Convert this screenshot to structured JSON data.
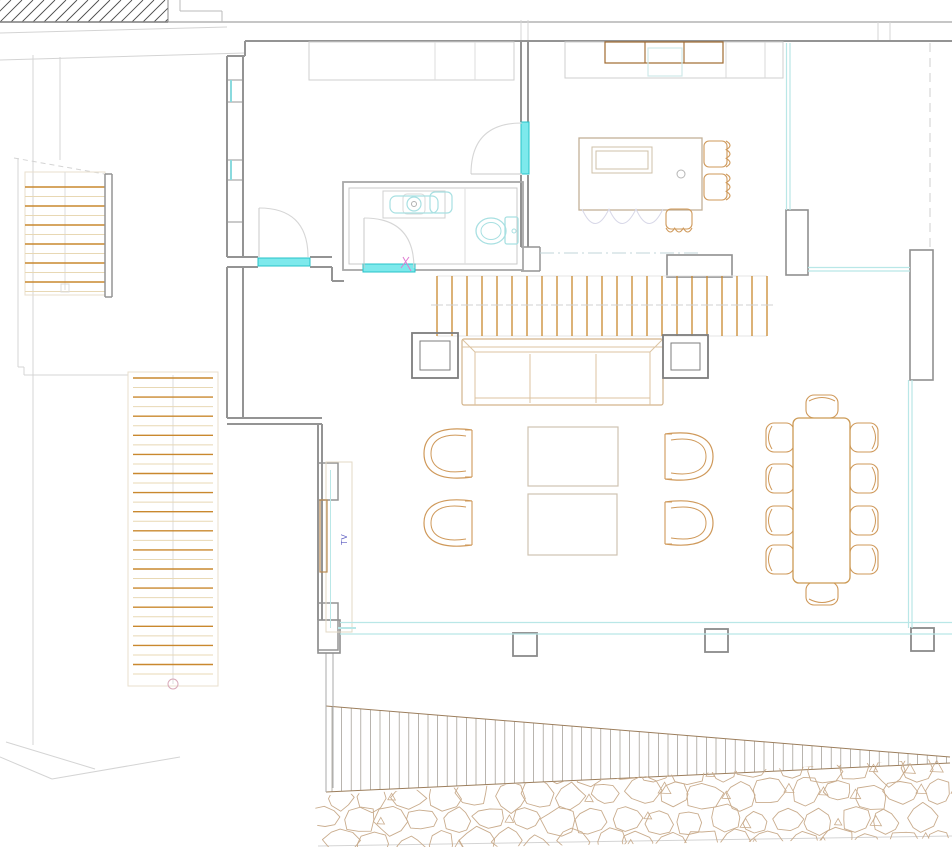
{
  "title": "Residential floor plan - living level (CAD drawing)",
  "labels": {
    "tv": "TV"
  },
  "colors": {
    "wall": "#949494",
    "wall_light": "#bfbfbf",
    "faint": "#dedede",
    "site": "#d4d4d4",
    "tan": "#cf995a",
    "tan_light": "#e3d2b8",
    "orange": "#c9882e",
    "tread_light": "#e8d8b4",
    "brown": "#a06a30",
    "gray_furniture": "#7e7e7e",
    "cyan_fill": "#7de9ec",
    "cyan_edge": "#27c3c9",
    "cyan": "#b9e7e7",
    "cyan_fixture": "#a8e0e2",
    "stone": "#c9ac8d",
    "wedge_edge": "#9c7e5c",
    "hatch_gray": "#9a958c",
    "hatch_dark": "#4a4a4a",
    "tv_text": "#5b5bc0",
    "pink": "#e07ad2",
    "scallop": "#d8d8e8",
    "dashdot": "#c2d4da",
    "arc": "#d6d6d6",
    "stair_box": "#e8dfce",
    "marker_pink": "#d8aab8"
  },
  "drawing": {
    "canvas": {
      "w": 952,
      "h": 847
    },
    "site_lines": [
      {
        "x1": 0,
        "y1": 22,
        "x2": 952,
        "y2": 22,
        "c": "#b3b3b3",
        "w": 1.4
      },
      {
        "x1": 0,
        "y1": 33,
        "x2": 227,
        "y2": 27
      },
      {
        "x1": 0,
        "y1": 60,
        "x2": 245,
        "y2": 53
      },
      {
        "x1": 33,
        "y1": 55,
        "x2": 33,
        "y2": 745
      },
      {
        "x1": 60,
        "y1": 57,
        "x2": 60,
        "y2": 160
      },
      {
        "x1": 18,
        "y1": 158,
        "x2": 18,
        "y2": 367
      },
      {
        "x1": 18,
        "y1": 367,
        "x2": 24,
        "y2": 367
      },
      {
        "x1": 24,
        "y1": 367,
        "x2": 24,
        "y2": 375
      },
      {
        "x1": 24,
        "y1": 375,
        "x2": 128,
        "y2": 375
      },
      {
        "x1": 14,
        "y1": 158,
        "x2": 110,
        "y2": 175,
        "dash": "5,4"
      },
      {
        "x1": 6,
        "y1": 742,
        "x2": 95,
        "y2": 769
      },
      {
        "x1": 0,
        "y1": 757,
        "x2": 52,
        "y2": 779
      },
      {
        "x1": 52,
        "y1": 779,
        "x2": 180,
        "y2": 757
      },
      {
        "x1": 318,
        "y1": 846,
        "x2": 952,
        "y2": 836
      },
      {
        "x1": 521,
        "y1": 20,
        "x2": 521,
        "y2": 41
      },
      {
        "x1": 528,
        "y1": 20,
        "x2": 528,
        "y2": 41
      },
      {
        "x1": 878,
        "y1": 22,
        "x2": 878,
        "y2": 41
      },
      {
        "x1": 890,
        "y1": 22,
        "x2": 890,
        "y2": 41
      },
      {
        "x1": 180,
        "y1": 0,
        "x2": 180,
        "y2": 11,
        "c": "#bbbbbb"
      },
      {
        "x1": 180,
        "y1": 11,
        "x2": 222,
        "y2": 11,
        "c": "#bbbbbb"
      },
      {
        "x1": 222,
        "y1": 11,
        "x2": 222,
        "y2": 22,
        "c": "#bbbbbb"
      }
    ],
    "walls": [
      {
        "x1": 245,
        "y1": 41,
        "x2": 952,
        "y2": 41,
        "w": 2
      },
      {
        "x1": 245,
        "y1": 41,
        "x2": 245,
        "y2": 56,
        "w": 2
      },
      {
        "x1": 227,
        "y1": 56,
        "x2": 245,
        "y2": 56,
        "w": 2
      },
      {
        "x1": 227,
        "y1": 56,
        "x2": 227,
        "y2": 257,
        "w": 2
      },
      {
        "x1": 243,
        "y1": 56,
        "x2": 243,
        "y2": 257,
        "w": 2
      },
      {
        "x1": 227,
        "y1": 80,
        "x2": 243,
        "y2": 80,
        "w": 1
      },
      {
        "x1": 227,
        "y1": 102,
        "x2": 243,
        "y2": 102,
        "w": 1
      },
      {
        "x1": 227,
        "y1": 160,
        "x2": 243,
        "y2": 160,
        "w": 1
      },
      {
        "x1": 227,
        "y1": 180,
        "x2": 243,
        "y2": 180,
        "w": 1
      },
      {
        "x1": 227,
        "y1": 222,
        "x2": 243,
        "y2": 222,
        "w": 1
      },
      {
        "x1": 227,
        "y1": 257,
        "x2": 258,
        "y2": 257,
        "w": 2
      },
      {
        "x1": 227,
        "y1": 267,
        "x2": 258,
        "y2": 267,
        "w": 2
      },
      {
        "x1": 310,
        "y1": 257,
        "x2": 332,
        "y2": 257,
        "w": 2
      },
      {
        "x1": 310,
        "y1": 267,
        "x2": 332,
        "y2": 267,
        "w": 2
      },
      {
        "x1": 332,
        "y1": 267,
        "x2": 332,
        "y2": 281,
        "w": 2
      },
      {
        "x1": 332,
        "y1": 281,
        "x2": 344,
        "y2": 281,
        "w": 2
      },
      {
        "x1": 521,
        "y1": 41,
        "x2": 521,
        "y2": 122,
        "w": 2
      },
      {
        "x1": 528,
        "y1": 41,
        "x2": 528,
        "y2": 122,
        "w": 2
      },
      {
        "x1": 521,
        "y1": 175,
        "x2": 521,
        "y2": 247,
        "w": 2
      },
      {
        "x1": 528,
        "y1": 175,
        "x2": 528,
        "y2": 247,
        "w": 2
      },
      {
        "x1": 521,
        "y1": 247,
        "x2": 540,
        "y2": 247,
        "w": 1.5
      },
      {
        "x1": 540,
        "y1": 247,
        "x2": 540,
        "y2": 271,
        "w": 1.5
      },
      {
        "x1": 521,
        "y1": 271,
        "x2": 540,
        "y2": 271,
        "w": 1.5
      },
      {
        "x1": 227,
        "y1": 267,
        "x2": 227,
        "y2": 418,
        "w": 2
      },
      {
        "x1": 243,
        "y1": 267,
        "x2": 243,
        "y2": 418,
        "w": 2
      },
      {
        "x1": 227,
        "y1": 418,
        "x2": 322,
        "y2": 418,
        "w": 2
      },
      {
        "x1": 227,
        "y1": 424,
        "x2": 322,
        "y2": 424,
        "w": 2
      },
      {
        "x1": 318,
        "y1": 424,
        "x2": 318,
        "y2": 620,
        "w": 2
      },
      {
        "x1": 322,
        "y1": 424,
        "x2": 322,
        "y2": 620,
        "w": 2
      },
      {
        "x1": 105,
        "y1": 174,
        "x2": 105,
        "y2": 297,
        "w": 1.5
      },
      {
        "x1": 112,
        "y1": 174,
        "x2": 112,
        "y2": 297,
        "w": 1.5
      },
      {
        "x1": 105,
        "y1": 174,
        "x2": 112,
        "y2": 174,
        "w": 1.5
      },
      {
        "x1": 105,
        "y1": 297,
        "x2": 112,
        "y2": 297,
        "w": 1.5
      },
      {
        "x1": 326,
        "y1": 653,
        "x2": 326,
        "y2": 792,
        "w": 1,
        "c": "#aaaaaa"
      },
      {
        "x1": 333,
        "y1": 653,
        "x2": 333,
        "y2": 788,
        "w": 1,
        "c": "#aaaaaa"
      }
    ],
    "rects": [
      {
        "x": 343,
        "y": 182,
        "w": 180,
        "h": 88,
        "c": "#a8a8a8",
        "sw": 1.8,
        "n": "bathroom-outline"
      },
      {
        "x": 349,
        "y": 188,
        "w": 168,
        "h": 76,
        "c": "#c9c9c9",
        "sw": 1,
        "n": "bathroom-inner"
      },
      {
        "x": 309,
        "y": 42,
        "w": 205,
        "h": 38,
        "c": "#cfcfcf",
        "sw": 1,
        "n": "wardrobe"
      },
      {
        "x": 667,
        "y": 255,
        "w": 65,
        "h": 22,
        "c": "#8f8f8f",
        "sw": 1.6,
        "n": "sideboard"
      },
      {
        "x": 786,
        "y": 210,
        "w": 22,
        "h": 65,
        "c": "#8f8f8f",
        "sw": 1.6,
        "n": "wall-pier"
      },
      {
        "x": 910,
        "y": 250,
        "w": 23,
        "h": 130,
        "c": "#8f8f8f",
        "sw": 1.6,
        "n": "wall-pier"
      },
      {
        "x": 318,
        "y": 620,
        "w": 22,
        "h": 33,
        "c": "#8f8f8f",
        "sw": 1.6,
        "n": "deck-wall-block"
      },
      {
        "x": 513,
        "y": 633,
        "w": 24,
        "h": 23,
        "c": "#8a8a8a",
        "sw": 1.8,
        "n": "deck-post"
      },
      {
        "x": 705,
        "y": 629,
        "w": 23,
        "h": 23,
        "c": "#8a8a8a",
        "sw": 1.8,
        "n": "deck-post"
      },
      {
        "x": 911,
        "y": 628,
        "w": 23,
        "h": 23,
        "c": "#8a8a8a",
        "sw": 1.8,
        "n": "deck-post"
      },
      {
        "x": 318,
        "y": 463,
        "w": 20,
        "h": 37,
        "c": "#949494",
        "sw": 1.5,
        "n": "tv-wall-pier"
      },
      {
        "x": 318,
        "y": 603,
        "w": 20,
        "h": 47,
        "c": "#949494",
        "sw": 1.5,
        "n": "tv-wall-pier"
      },
      {
        "x": 326,
        "y": 462,
        "w": 26,
        "h": 170,
        "c": "#e3d9c6",
        "sw": 1,
        "n": "tv-niche"
      },
      {
        "x": 320,
        "y": 500,
        "w": 7,
        "h": 72,
        "c": "#b98a50",
        "sw": 1.2,
        "n": "tv-board"
      },
      {
        "x": 61,
        "y": 284,
        "w": 8,
        "h": 8,
        "c": "#dcdcdc",
        "sw": 1,
        "n": "stair-marker"
      }
    ],
    "faint_lines": [
      {
        "x1": 435,
        "y1": 42,
        "x2": 435,
        "y2": 80
      },
      {
        "x1": 475,
        "y1": 42,
        "x2": 475,
        "y2": 80
      },
      {
        "x1": 465,
        "y1": 188,
        "x2": 465,
        "y2": 264
      },
      {
        "x1": 540,
        "y1": 253,
        "x2": 700,
        "y2": 253,
        "dash": "14,4,2,4",
        "c": "#c2d4da"
      },
      {
        "x1": 930,
        "y1": 43,
        "x2": 930,
        "y2": 250,
        "dash": "9,6",
        "c": "#cfcfcf"
      }
    ],
    "cyan_bands": [
      {
        "x": 258,
        "y": 258,
        "w": 52,
        "h": 8,
        "n": "window-sill"
      },
      {
        "x": 363,
        "y": 264,
        "w": 52,
        "h": 8,
        "n": "door-threshold"
      },
      {
        "x": 521,
        "y": 122,
        "w": 8,
        "h": 52,
        "n": "door-threshold"
      }
    ],
    "cyan_lines": [
      {
        "x1": 786.5,
        "y1": 43,
        "x2": 786.5,
        "y2": 210
      },
      {
        "x1": 790,
        "y1": 43,
        "x2": 790,
        "y2": 210
      },
      {
        "x1": 808,
        "y1": 267.5,
        "x2": 910,
        "y2": 267.5
      },
      {
        "x1": 808,
        "y1": 271,
        "x2": 910,
        "y2": 271
      },
      {
        "x1": 908.5,
        "y1": 380,
        "x2": 908.5,
        "y2": 628
      },
      {
        "x1": 912,
        "y1": 380,
        "x2": 912,
        "y2": 628
      },
      {
        "x1": 340,
        "y1": 622.5,
        "x2": 952,
        "y2": 622.5
      },
      {
        "x1": 340,
        "y1": 634,
        "x2": 952,
        "y2": 634
      },
      {
        "x1": 330.5,
        "y1": 470,
        "x2": 330.5,
        "y2": 628,
        "w": 1
      },
      {
        "x1": 338,
        "y1": 628,
        "x2": 356,
        "y2": 628,
        "w": 2
      },
      {
        "x1": 231,
        "y1": 80,
        "x2": 231,
        "y2": 102,
        "w": 2,
        "c": "#8adade"
      },
      {
        "x1": 231,
        "y1": 160,
        "x2": 231,
        "y2": 180,
        "w": 2,
        "c": "#8adade"
      }
    ],
    "door_arcs": [
      {
        "d": "M 471,174 Q 471,123 522,123",
        "leaf": [
          471,
          174,
          522,
          174
        ]
      },
      {
        "d": "M 259,208 Q 308,208 308,257",
        "leaf": [
          259,
          208,
          259,
          257
        ]
      },
      {
        "d": "M 364,218 Q 414,218 414,268",
        "leaf": [
          364,
          218,
          364,
          268
        ]
      }
    ],
    "details": [
      {
        "x1": 403,
        "y1": 257,
        "x2": 411,
        "y2": 271,
        "c": "#e07ad2",
        "w": 1
      },
      {
        "x1": 409,
        "y1": 257,
        "x2": 401,
        "y2": 268,
        "c": "#e07ad2",
        "w": 1
      }
    ],
    "hatch_block": {
      "x": 0,
      "y": 0,
      "w": 168,
      "h": 22,
      "spacing": 11
    },
    "wedge": {
      "x1": 326,
      "y1t": 706,
      "y1b": 792,
      "x2": 950,
      "y2t": 757,
      "y2b": 763,
      "spacing": 9.6
    },
    "stones": {
      "seed": 7,
      "rows": [
        768,
        794,
        820,
        843
      ],
      "x0": 326,
      "x1": 948,
      "dx": 33,
      "clip": [
        [
          314,
          796
        ],
        [
          952,
          758
        ],
        [
          952,
          838
        ],
        [
          320,
          850
        ]
      ]
    },
    "slats": {
      "x0": 437,
      "x1": 767,
      "count": 23,
      "y0": 276,
      "y1": 336,
      "tick_y": 305
    },
    "stairs": {
      "upper": {
        "box": [
          25,
          172,
          80,
          123
        ],
        "x": 25,
        "w": 80,
        "y0": 187,
        "step": 19,
        "count": 6,
        "center_x": 65,
        "center_y": [
          172,
          290
        ]
      },
      "lower": {
        "box": [
          128,
          372,
          90,
          314
        ],
        "x": 133,
        "w": 80,
        "y0": 378,
        "step": 19.1,
        "count": 16,
        "center_x": 173,
        "center_y": [
          375,
          684
        ],
        "circle": [
          173,
          684,
          5
        ]
      }
    },
    "bathroom": {
      "sink_counter": [
        383,
        191,
        62,
        27
      ],
      "faucet_box": [
        403,
        194,
        22,
        20
      ],
      "sink_basin": [
        390,
        196,
        48,
        17
      ],
      "faucet": [
        414,
        204,
        7
      ],
      "faucet_inner": [
        414,
        204,
        2.5
      ],
      "soap": [
        430,
        192,
        22,
        21
      ],
      "toilet_bowl": [
        491,
        231,
        15,
        13
      ],
      "toilet_bowl_inner": [
        491,
        231,
        10,
        8.5
      ],
      "toilet_tank": [
        505,
        217,
        13,
        27
      ],
      "toilet_btn": [
        514,
        231,
        2
      ]
    },
    "kitchen": {
      "counter": [
        565,
        42,
        218,
        36
      ],
      "counter_dividers": [
        726,
        765
      ],
      "cabinet": [
        605,
        42,
        118,
        21
      ],
      "cabinet_dividers": [
        645,
        684
      ],
      "sink_cab": [
        648,
        48,
        34,
        28
      ],
      "island": [
        579,
        138,
        123,
        72
      ],
      "island_inner": [
        [
          592,
          147,
          60,
          26
        ],
        [
          596,
          151,
          52,
          18
        ]
      ],
      "knob": [
        681,
        174,
        4
      ],
      "scallops": "M 582,209 Q 595,238 609,209 Q 622,238 636,209 Q 649,238 663,209"
    },
    "furniture": {
      "sofa": {
        "rect": [
          462,
          339,
          201,
          66
        ],
        "lines": [
          [
            462,
            347,
            663,
            347
          ],
          [
            475,
            352,
            650,
            352
          ],
          [
            475,
            352,
            475,
            405
          ],
          [
            650,
            352,
            650,
            405
          ],
          [
            530,
            354,
            530,
            403
          ],
          [
            596,
            354,
            596,
            403
          ],
          [
            475,
            398,
            650,
            398
          ],
          [
            463,
            340,
            475,
            352
          ],
          [
            662,
            340,
            650,
            352
          ]
        ]
      },
      "side_tables": [
        {
          "outer": [
            412,
            333,
            46,
            45
          ],
          "inner": [
            420,
            341,
            30,
            29
          ]
        },
        {
          "outer": [
            663,
            335,
            45,
            43
          ],
          "inner": [
            671,
            343,
            29,
            27
          ]
        }
      ],
      "coffee_tables": [
        [
          528,
          427,
          90,
          59
        ],
        [
          528,
          494,
          89,
          61
        ]
      ],
      "armchairs": [
        {
          "x": 424,
          "y": 425,
          "w": 56,
          "h": 57,
          "dir": 1
        },
        {
          "x": 424,
          "y": 496,
          "w": 56,
          "h": 54,
          "dir": 1
        },
        {
          "x": 657,
          "y": 429,
          "w": 56,
          "h": 55,
          "dir": -1
        },
        {
          "x": 657,
          "y": 497,
          "w": 56,
          "h": 52,
          "dir": -1
        }
      ],
      "stools": [
        {
          "x": 703,
          "y": 139,
          "w": 32,
          "h": 30,
          "side": "right"
        },
        {
          "x": 703,
          "y": 172,
          "w": 32,
          "h": 30,
          "side": "right"
        },
        {
          "x": 664,
          "y": 208,
          "w": 30,
          "h": 29,
          "side": "bottom"
        }
      ],
      "dining": {
        "table": [
          793,
          418,
          57,
          165
        ],
        "side_chairs": {
          "w": 28,
          "h": 29,
          "left_x": 766,
          "right_x": 850,
          "ys": [
            423,
            464,
            506,
            545
          ]
        },
        "end_chairs": [
          {
            "x": 806,
            "y": 395,
            "w": 32,
            "h": 23,
            "side": "top"
          },
          {
            "x": 806,
            "y": 582,
            "w": 32,
            "h": 23,
            "side": "bottom"
          }
        ]
      }
    },
    "tv_label_pos": {
      "x": 347,
      "y": 545
    }
  }
}
